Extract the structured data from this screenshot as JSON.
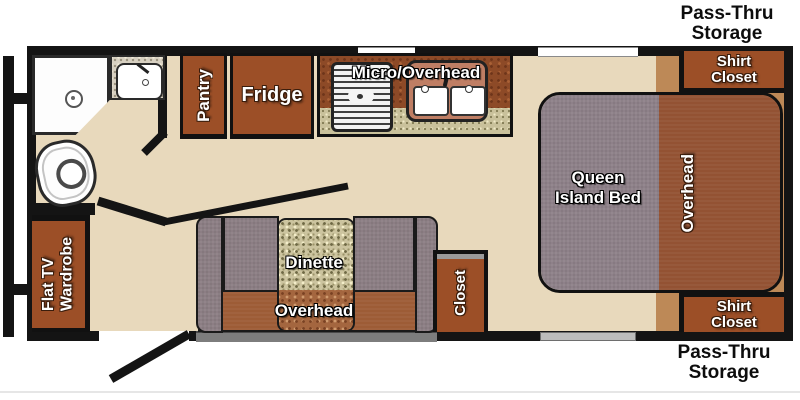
{
  "title": "Travel trailer floor plan",
  "colors": {
    "floor": "#e8d9bc",
    "wall": "#141414",
    "cabinet_brown": "#9c4f27",
    "overhead_brown": "#935233",
    "platform_tan": "#bd8957",
    "bed_gray": "#8e8189",
    "bench_gray": "#8c7e84",
    "table_speckle": "#ccc49f",
    "counter_speckle": "#c9c19b",
    "kitchen_mottle": "#8d4a27"
  },
  "labels": {
    "pass_thru_top": {
      "line1": "Pass-Thru",
      "line2": "Storage"
    },
    "shirt_closet_top": {
      "line1": "Shirt",
      "line2": "Closet"
    },
    "pantry": "Pantry",
    "fridge": "Fridge",
    "micro_overhead": "Micro/Overhead",
    "queen_bed": {
      "line1": "Queen",
      "line2": "Island Bed"
    },
    "overhead_bedroom": "Overhead",
    "flat_tv_wardrobe": {
      "line1": "Flat TV",
      "line2": "Wardrobe"
    },
    "dinette": "Dinette",
    "overhead_dinette": "Overhead",
    "closet": "Closet",
    "shirt_closet_bottom": {
      "line1": "Shirt",
      "line2": "Closet"
    },
    "pass_thru_bottom": {
      "line1": "Pass-Thru",
      "line2": "Storage"
    }
  },
  "fixtures": {
    "shower": "corner-shower",
    "bath_sink": "bathroom-sink",
    "toilet": "toilet",
    "stove": "cooktop",
    "kitchen_sink": "double-kitchen-sink",
    "entry_door": "entry-door-swing",
    "bath_door": "bathroom-door-swing"
  }
}
